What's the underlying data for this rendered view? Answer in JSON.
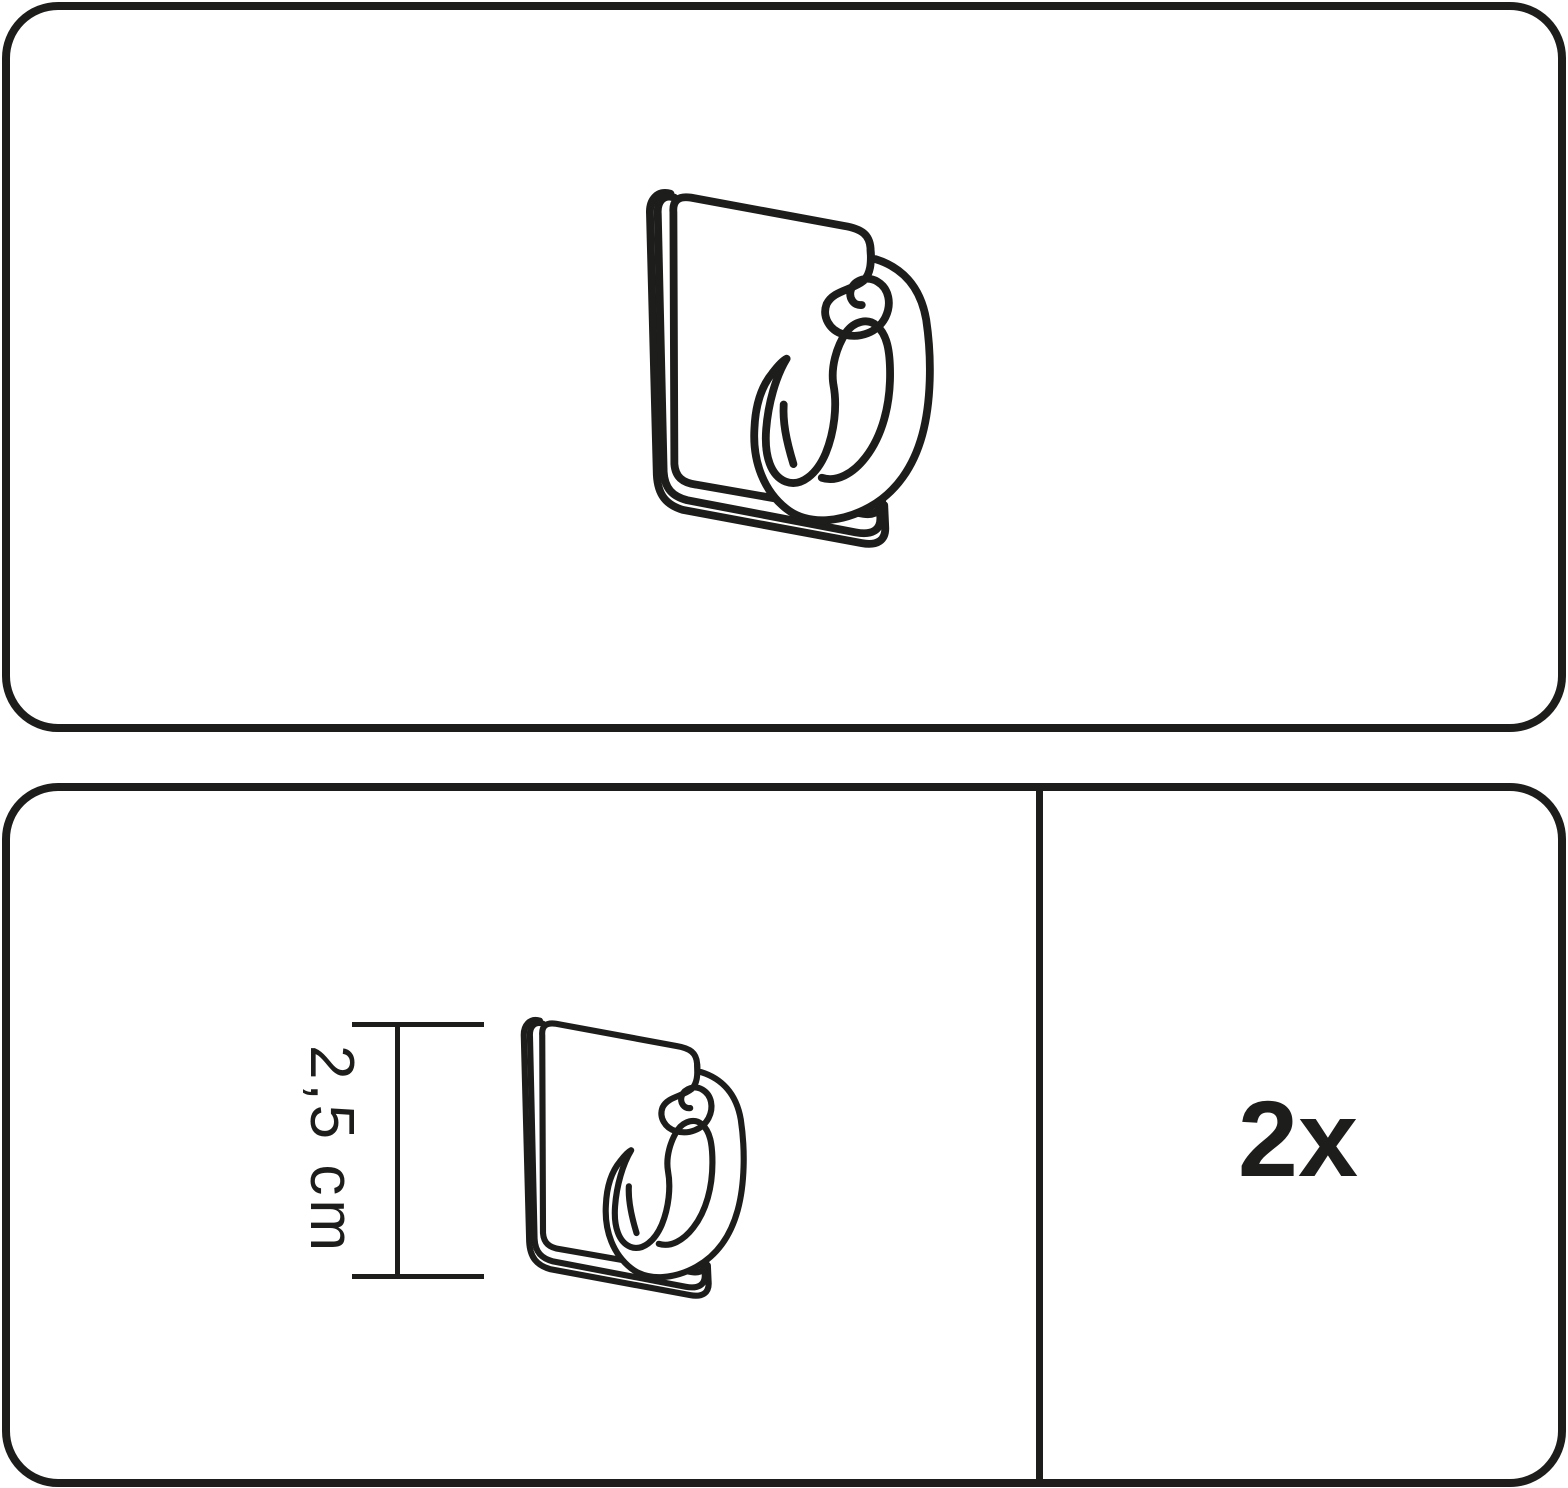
{
  "colors": {
    "ink": "#1d1d1b",
    "background": "#ffffff"
  },
  "top_panel": {
    "illustration": "adhesive-hook-icon"
  },
  "bottom_panel": {
    "left_section": {
      "illustration": "adhesive-hook-icon",
      "dimension": {
        "label": "2,5 cm",
        "value": 2.5,
        "unit": "cm",
        "measures": "hook height"
      }
    },
    "right_section": {
      "quantity": {
        "label": "2x",
        "count": 2
      }
    }
  }
}
